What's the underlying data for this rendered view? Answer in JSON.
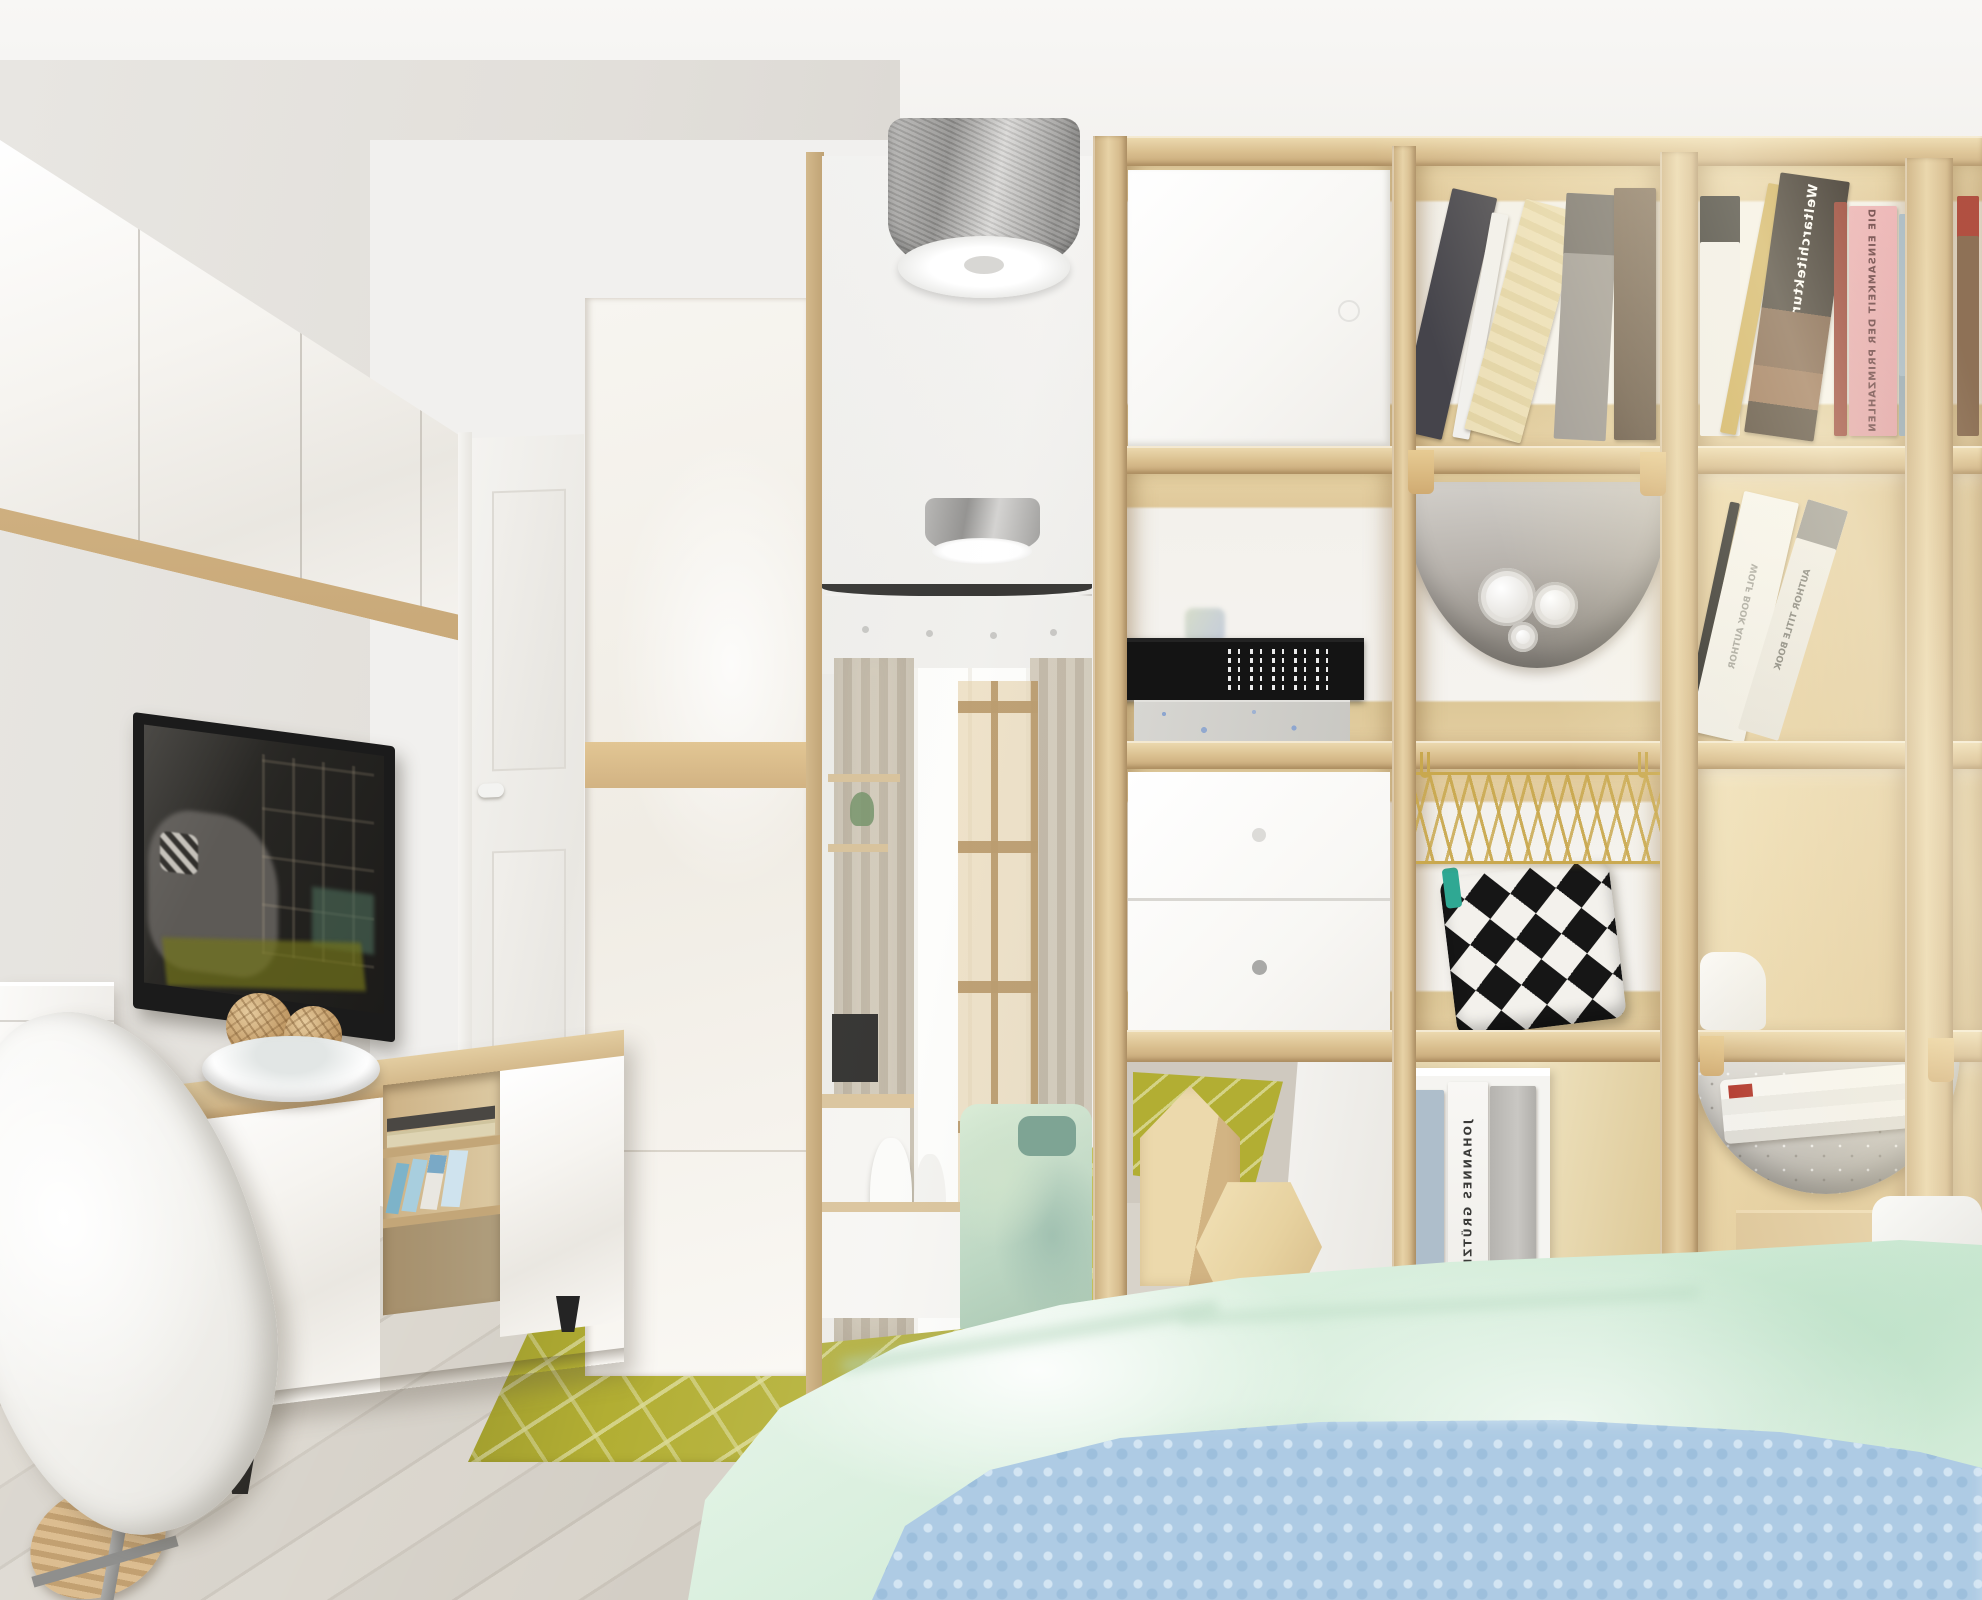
{
  "scene": {
    "type": "interior-3d-render",
    "room_label": "scandinavian studio apartment with shelf room divider",
    "camera": "eye-level, one-point perspective down the room"
  },
  "palette": {
    "ceiling": "#f5f4f2",
    "wall": "#e9e7e4",
    "floor_wood": "#d6d1c8",
    "floor_seam": "#c4beb4",
    "shelf_wood_light": "#e7d2a6",
    "shelf_wood_dark": "#c6a778",
    "glossy_white": "#f7f5f1",
    "rug_base": "#b2ae33",
    "rug_pattern": "#dad994",
    "mint_blanket": "#d6edda",
    "blue_blanket": "#aecbe4",
    "gold_basket": "#c9a84e",
    "felt_gray": "#b5b1ab",
    "tv_frame": "#1b1b1b",
    "tv_brand_mark": "#cf3a2c",
    "black_box": "#141414"
  },
  "divider": {
    "label": "4x4 cube shelving unit used as room divider",
    "rows": 4,
    "cols": 4,
    "note": "book spine titles appear mirrored in the render",
    "books": {
      "weltarchitektur": "Weltarchitektur",
      "primzahlen": "DIE EINSAMKEIT DER PRIMZAHLEN",
      "gruetzke": "JOHANNES GRÜTZKE",
      "author_title": "AUTHOR TITLE BOOK",
      "wolf_book": "WOLF BOOK AUTHOR"
    },
    "inserts": [
      "white door insert",
      "white two-drawer insert",
      "white storage cube"
    ],
    "accessories": [
      "gray felt hammock with paper rolls",
      "gold wire basket",
      "black-white aztec cushion",
      "knit hammock with magazines",
      "cardboard box",
      "wooden house decor",
      "wooden hexagon decor",
      "black storage box",
      "concrete-pattern box"
    ]
  },
  "left_wall": {
    "items": [
      "glossy white wall cabinets with oak underside",
      "wall-mounted flat TV (off, reflecting room)",
      "white-and-oak TV sideboard",
      "white shell desk chair",
      "white desk unit",
      "bowl with rattan balls"
    ]
  },
  "center": {
    "items": [
      "white panel interior door",
      "glossy white wardrobe with oak band",
      "full-height mirror reflecting the room",
      "round metallic ceiling lamp",
      "olive geometric rug",
      "whitewashed plank floor"
    ]
  },
  "bed": {
    "items": [
      "mint satin duvet",
      "light-blue chunky blanket",
      "white pillow"
    ]
  }
}
